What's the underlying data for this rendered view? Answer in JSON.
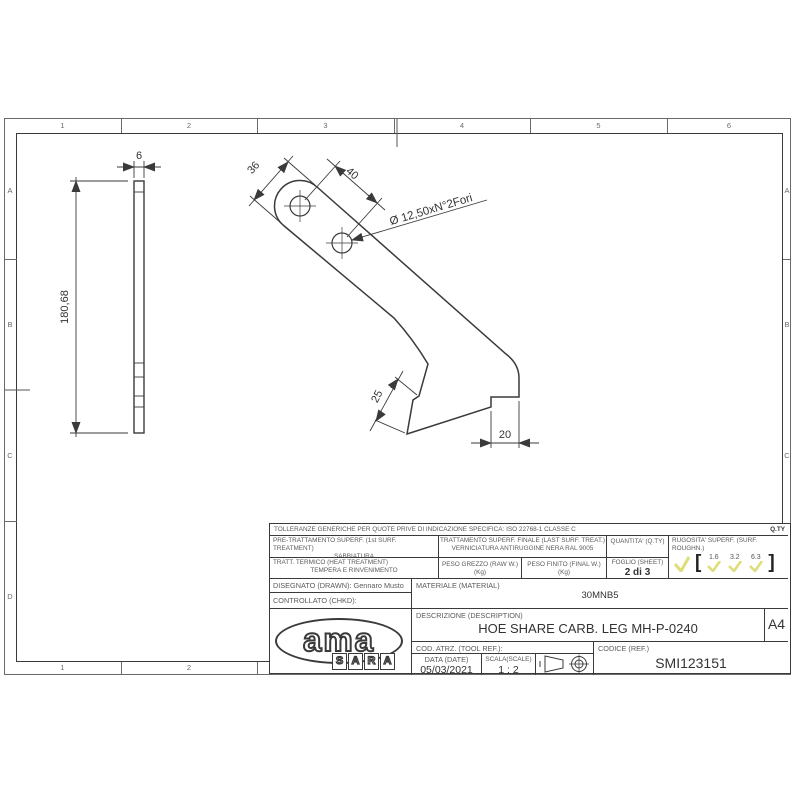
{
  "sheet": {
    "grid_top": [
      "1",
      "2",
      "3",
      "4",
      "5",
      "6"
    ],
    "grid_bottom": [
      "1",
      "2"
    ],
    "grid_left": [
      "A",
      "B",
      "C",
      "D"
    ],
    "grid_right": [
      "A",
      "B",
      "C"
    ]
  },
  "views": {
    "side": {
      "thickness": "6",
      "height": "180,68"
    },
    "front": {
      "width": "36",
      "hole_spacing": "40",
      "holes_note": "Ø 12,50xN°2Fori",
      "foot_face": "25",
      "step": "20"
    }
  },
  "title_block": {
    "tolerance_note": "TOLLERANZE GENERICHE PER QUOTE PRIVE DI INDICAZIONE SPECIFICA: ISO 22768-1 CLASSE C",
    "qty_label": "Q.TY",
    "pre_treatment_label": "PRE-TRATTAMENTO SUPERF. (1st SURF. TREATMENT)",
    "pre_treatment_value": "SABBIATURA",
    "final_treatment_label": "TRATTAMENTO SUPERF. FINALE (LAST SURF. TREAT.)",
    "final_treatment_value": "VERNICIATURA ANTIRUGGINE NERA RAL 9005",
    "heat_treatment_label": "TRATT. TERMICO (HEAT TREATMENT)",
    "heat_treatment_value": "TEMPERA E RINVENIMENTO",
    "raw_weight_label": "PESO GREZZO (RAW W.) (Kg)",
    "final_weight_label": "PESO FINITO (FINAL W.) (Kg)",
    "quantity_label": "QUANTITA' (Q.TY)",
    "sheet_label": "FOGLIO (SHEET)",
    "sheet_value": "2 di 3",
    "roughness_label_1": "RUGOSITA' SUPERF. (SURF.",
    "roughness_label_2": "ROUGHN.)",
    "roughness_values": [
      "1.6",
      "3.2",
      "6.3"
    ],
    "bracket_open": "[",
    "bracket_close": "]",
    "drawn_label": "DISEGNATO (DRAWN): Gennaro Musto",
    "checked_label": "CONTROLLATO (CHKD):",
    "material_label": "MATERIALE (MATERIAL)",
    "material_value": "30MNB5",
    "description_label": "DESCRIZIONE (DESCRIPTION)",
    "description_value": "HOE SHARE CARB. LEG MH-P-0240",
    "format": "A4",
    "tool_ref_label": "COD. ATRZ. (TOOL REF.):",
    "date_label": "DATA (DATE)",
    "date_value": "05/03/2021",
    "scale_label": "SCALA(SCALE)",
    "scale_value": "1 : 2",
    "code_label": "CODICE (REF.)",
    "code_value": "SMI123151",
    "logo_text": "ama",
    "logo_letters": [
      "S",
      "A",
      "R",
      "A"
    ],
    "accent_check_color": "#dede78"
  }
}
